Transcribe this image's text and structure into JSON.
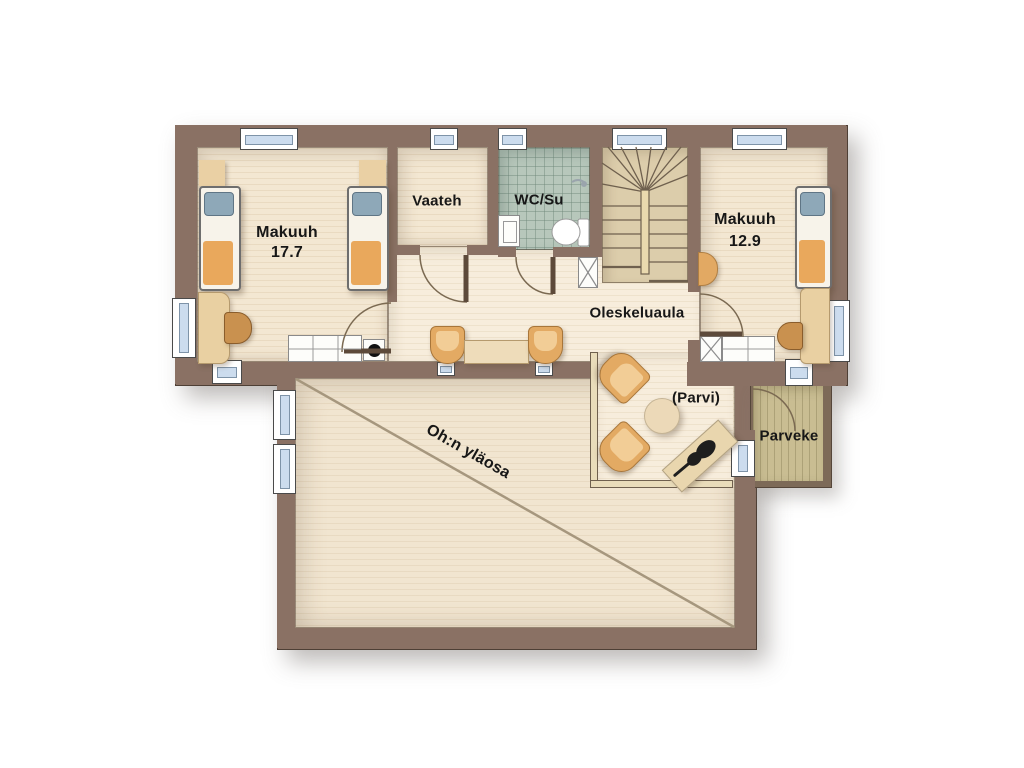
{
  "drawing": {
    "type": "architectural floor plan",
    "floor": "upper floor of a house"
  },
  "labels": {
    "bedroom1": {
      "name": "Makuuh",
      "area": "17.7"
    },
    "closet": {
      "name": "Vaateh"
    },
    "wc": {
      "name": "WC/Su"
    },
    "bedroom2": {
      "name": "Makuuh",
      "area": "12.9"
    },
    "hall": {
      "name": "Oleskeluaula"
    },
    "loft": {
      "name": "(Parvi)"
    },
    "balcony": {
      "name": "Parveke"
    },
    "living_room_void": {
      "name": "Oh:n yläosa"
    }
  },
  "colors": {
    "wall": "#8a7164",
    "floor_cream": "#f3e7d2",
    "floor_hall": "#f7eddc",
    "tile": "#b7c7bb",
    "stair_floor": "#dccdab",
    "balcony_floor": "#c9bd92",
    "void_floor": "#f1e5d0",
    "railing": "#e9dcba",
    "window_pane": "#ccdcee",
    "bed_blanket_orange": "#e9a85c",
    "bed_pillow_blue": "#8ea8b8",
    "furniture_tan": "#e3aa63",
    "label_text": "#171717"
  }
}
